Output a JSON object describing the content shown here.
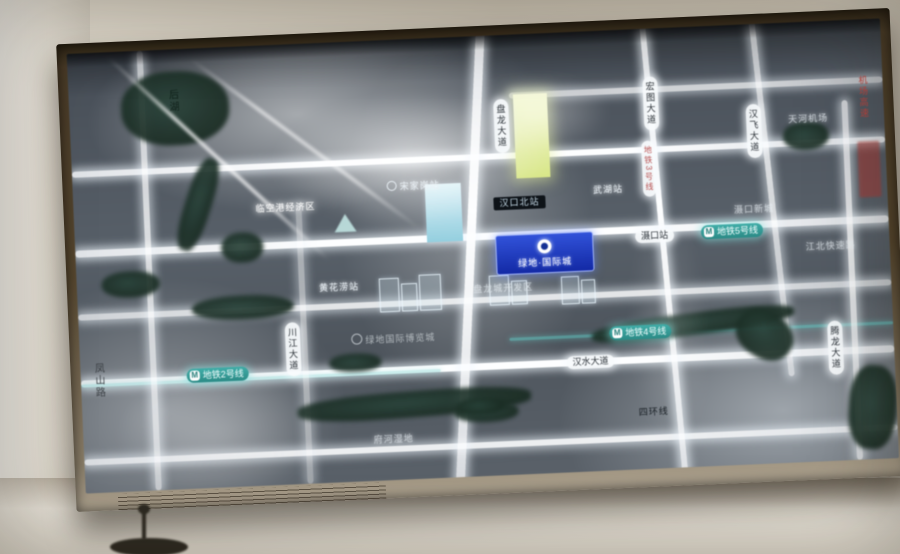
{
  "map": {
    "plaque": {
      "title": "绿地·国际城"
    },
    "poi_logo_label": "绿地国际博览城",
    "metro_badges": {
      "line2": "地铁2号线",
      "line4": "地铁4号线",
      "line5": "地铁5号线",
      "line3_vertical": "地铁3号线"
    },
    "road_pills": {
      "panlong": "盘龙大道",
      "hongtu": "宏图大道",
      "hanfei": "汉飞大道",
      "tenglong": "腾龙大道",
      "chuanjiang": "川江大道",
      "hanshui": "汉水大道",
      "shekou_station": "滠口站"
    },
    "labels": {
      "linkong": "临空港经济区",
      "songjiagang": "宋家岗站",
      "hankoubei": "汉口北站",
      "wuhu": "武湖站",
      "shekou_newtown": "滠口新城",
      "tianhe": "天河机场",
      "jiangbei": "江北快速路",
      "huanghualao": "黄花涝站",
      "panlongcheng": "盘龙城开发区",
      "sihuan": "四环线",
      "fuhe": "府河湿地",
      "fengshan": "凤山路",
      "airport_expwy": "机场高速",
      "lake": "后湖"
    }
  }
}
